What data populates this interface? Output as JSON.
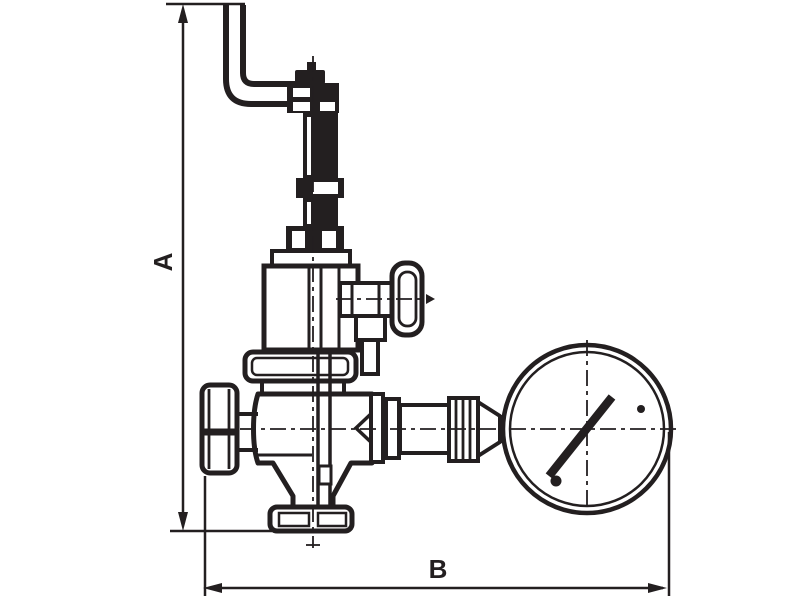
{
  "labels": {
    "dim_a": "A",
    "dim_b": "B"
  },
  "colors": {
    "ink": "#231f20",
    "paper": "#ffffff"
  }
}
